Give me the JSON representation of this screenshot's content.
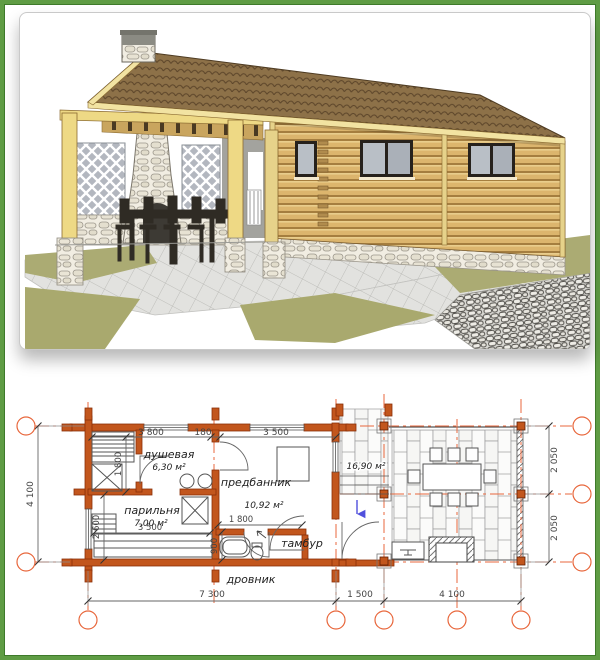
{
  "page": {
    "frame_border_color": "#5f9c44",
    "background": "#ffffff"
  },
  "render": {
    "description": "3D exterior rendering of a wooden log bathhouse with covered terrace, stone fireplace, dining furniture and paved yard with lawn",
    "colors": {
      "roof": "#8d7148",
      "logs": "#dcb56d",
      "trim": "#eed985",
      "stone": "#f1ede2",
      "grass": "#abab73",
      "paving": "#e4e4e2"
    }
  },
  "floor_plan": {
    "labels": {
      "shower": "душевая",
      "shower_area": "6,30 м²",
      "steam": "парильня",
      "steam_area": "7,00 м²",
      "anteroom": "предбанник",
      "anteroom_area": "10,92 м²",
      "vestibule": "тамбур",
      "woodshed": "дровник",
      "terrace_area": "16,90 м²"
    },
    "dimensions": {
      "top": [
        "3 800",
        "180",
        "3 500"
      ],
      "inner_vertical": [
        "1 800",
        "2 600",
        "900"
      ],
      "inner_horizontal": [
        "3 500",
        "1 800"
      ],
      "left": [
        "4 100"
      ],
      "right": [
        "2 050",
        "2 050"
      ],
      "bottom": [
        "7 300",
        "1 500",
        "4 100"
      ]
    },
    "colors": {
      "wall": "#c2561d",
      "axis": "#e8673c"
    }
  }
}
